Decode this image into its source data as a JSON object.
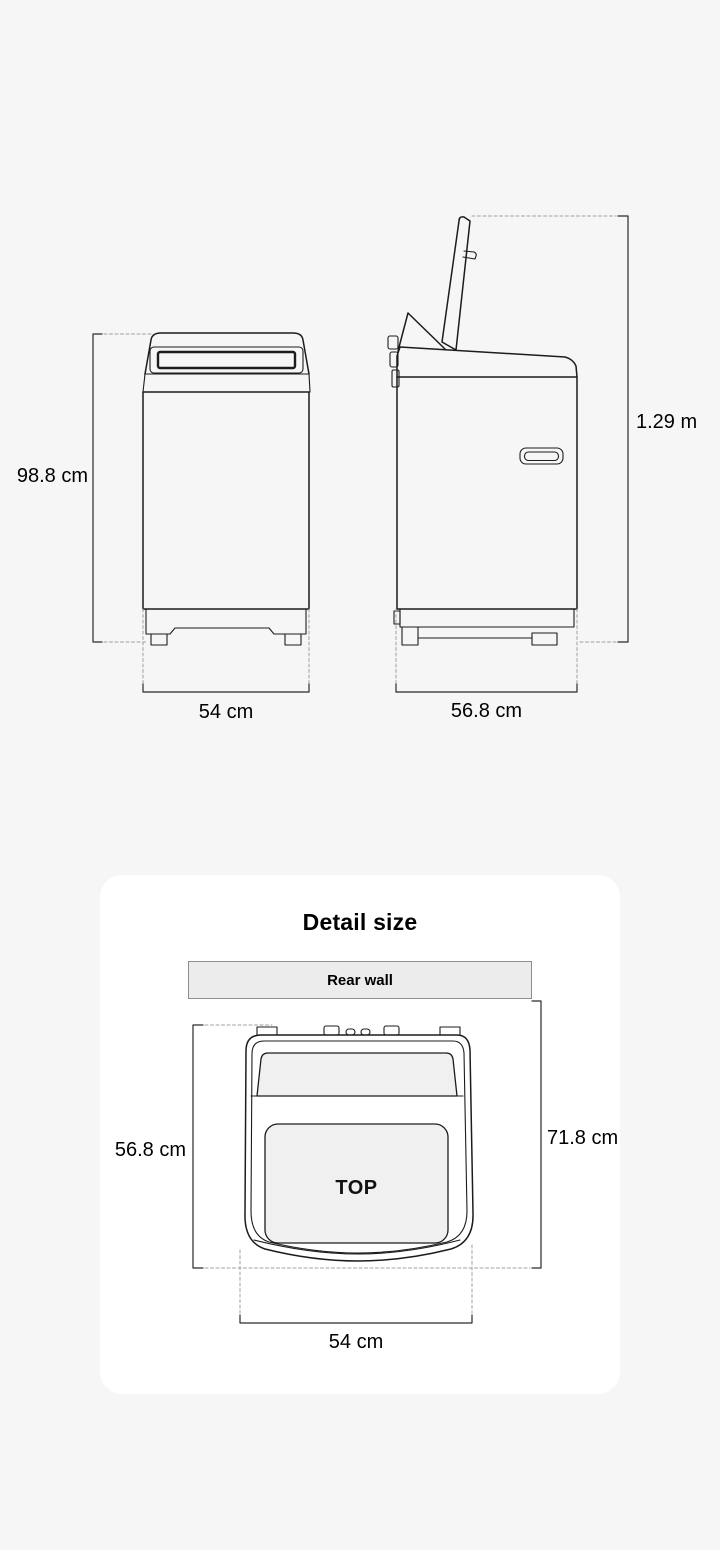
{
  "page": {
    "background": "#f6f6f6"
  },
  "dimension_diagram": {
    "front_view": {
      "height": "98.8 cm",
      "width": "54 cm"
    },
    "side_view": {
      "height_lid_open": "1.29 m",
      "depth": "56.8 cm"
    }
  },
  "detail_card": {
    "title": "Detail size",
    "rear_wall": "Rear wall",
    "top_view": {
      "label": "TOP",
      "depth": "56.8 cm",
      "wall_to_front": "71.8 cm",
      "width": "54 cm"
    }
  },
  "colors": {
    "page_bg": "#f6f6f6",
    "card_bg": "#ffffff",
    "line_art": "#1c1c1c",
    "dashed_line": "#a0a0a0",
    "panel_fill": "#f0f0f0",
    "rear_wall_fill": "#ececec",
    "rear_wall_border": "#8d8d8d",
    "text": "#000000"
  }
}
